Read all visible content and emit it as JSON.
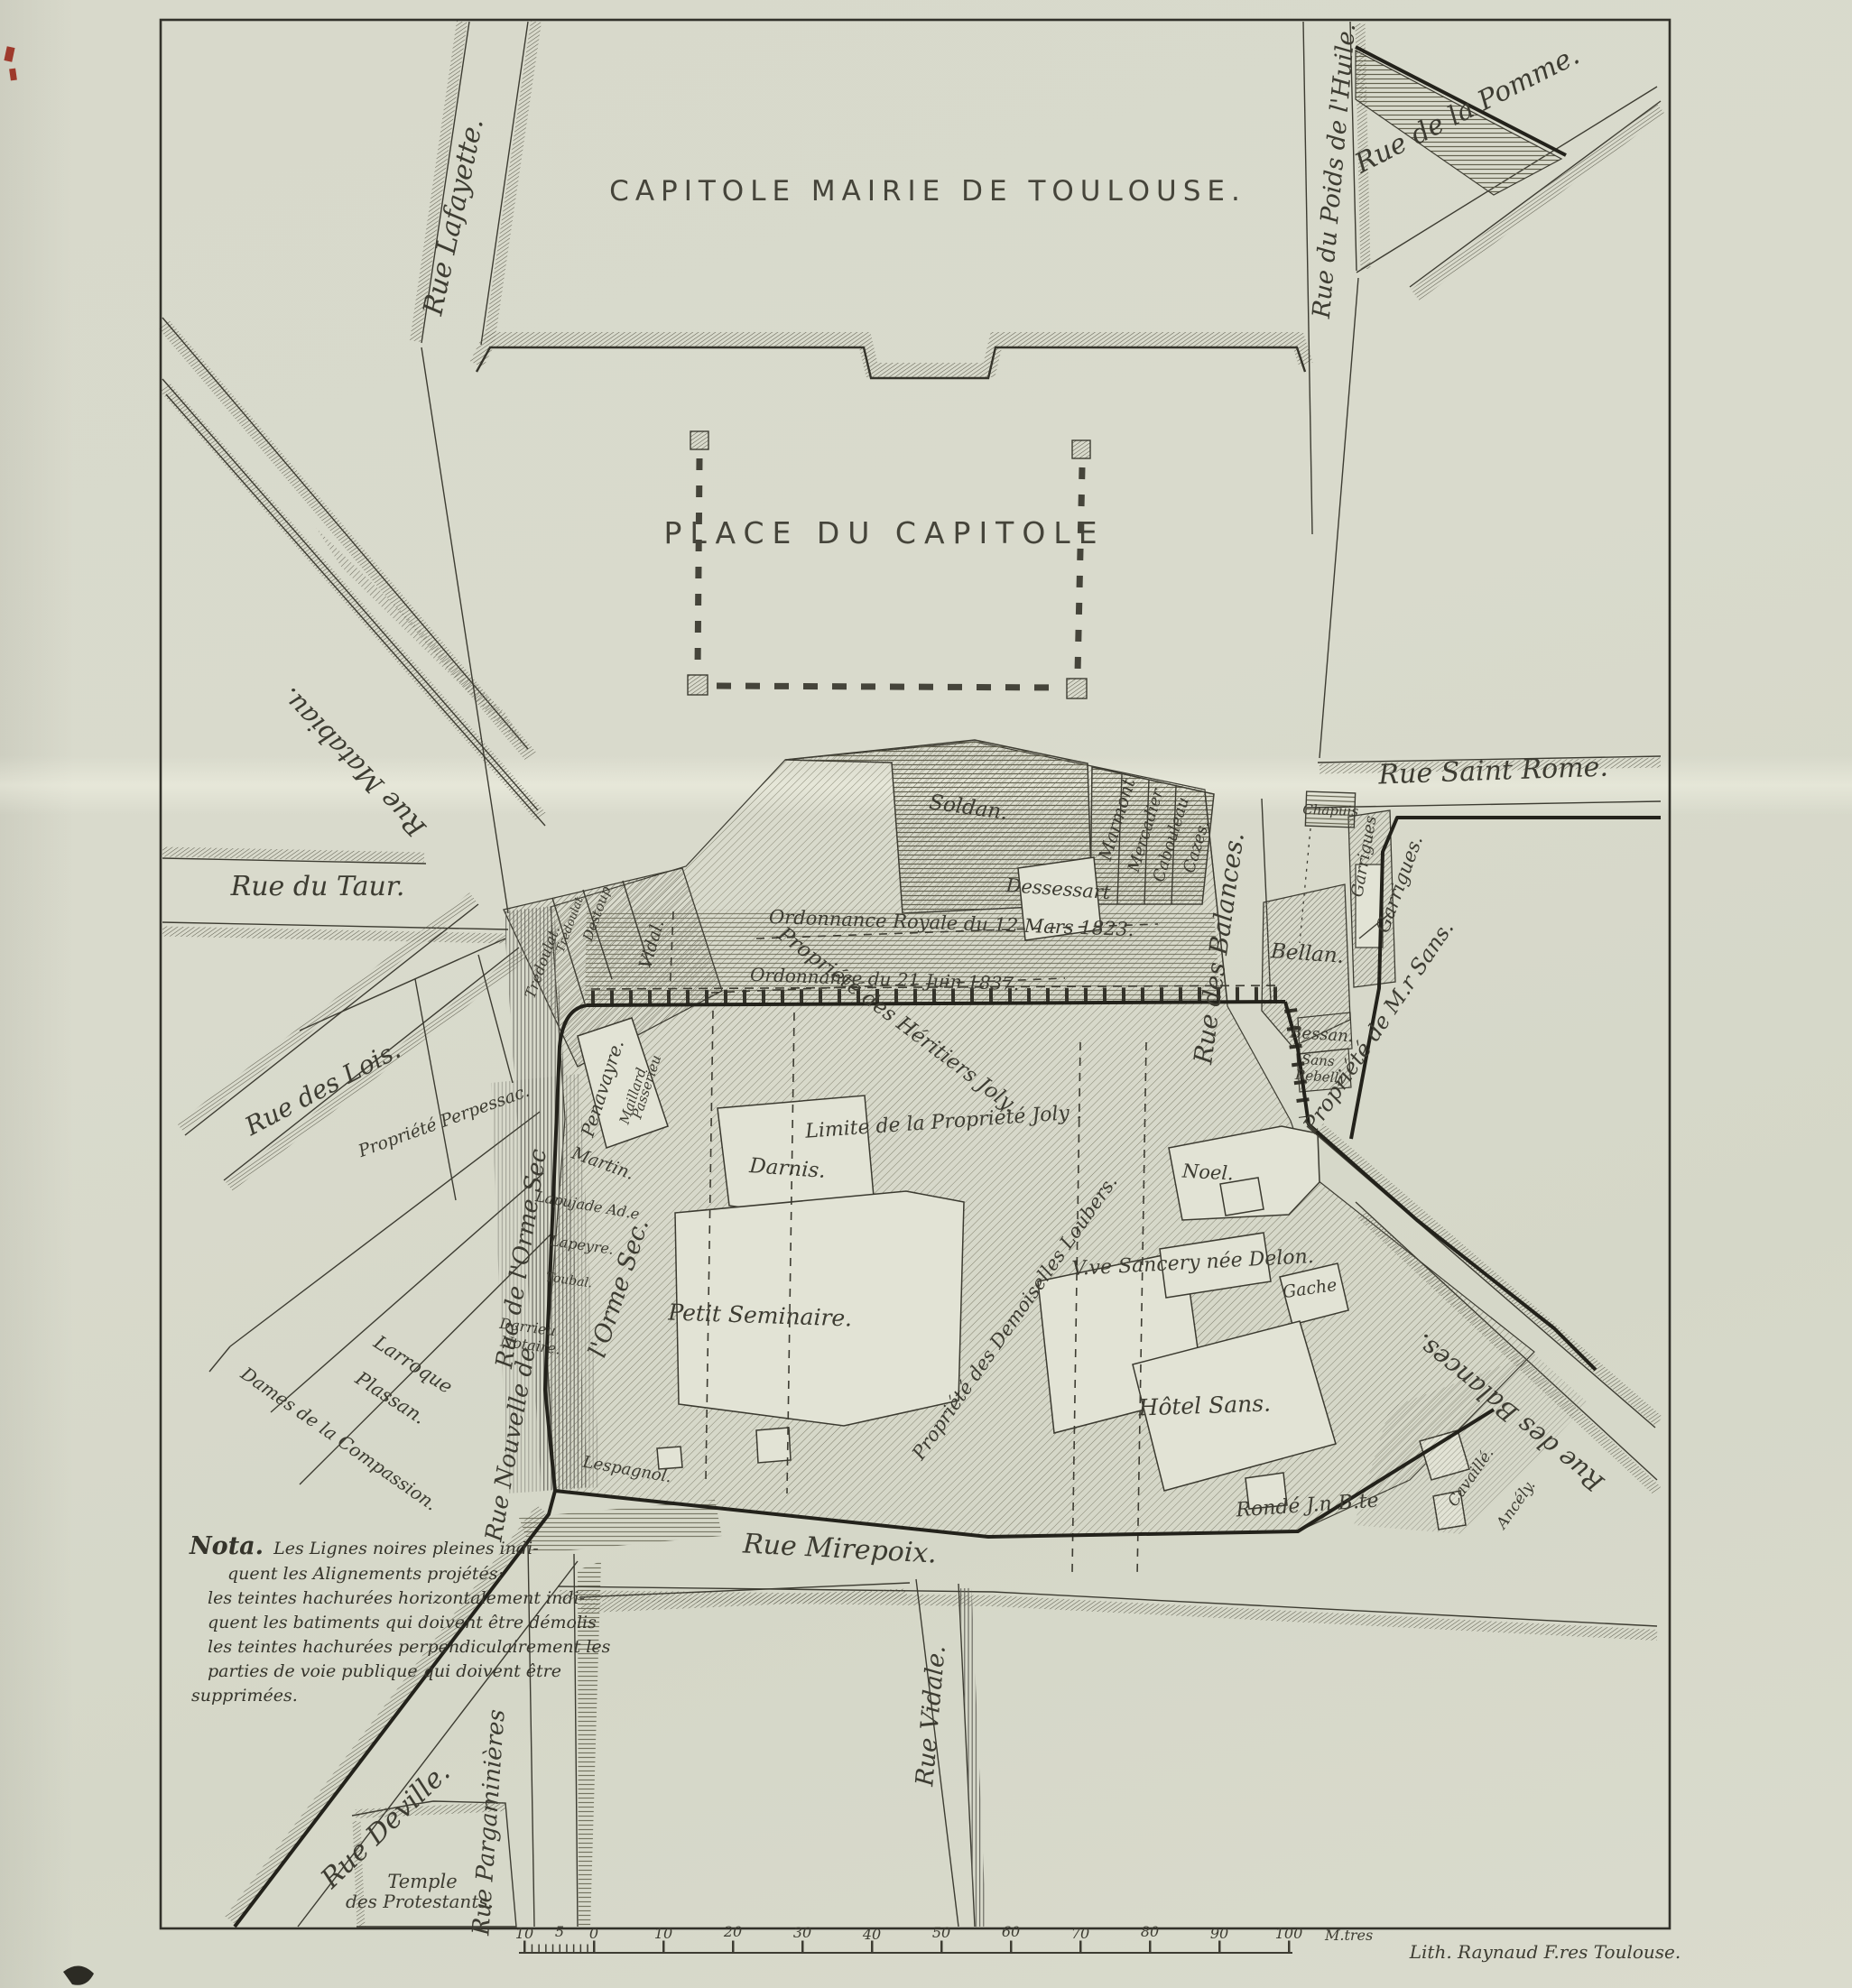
{
  "map": {
    "title": "CAPITOLE  MAIRIE  DE  TOULOUSE.",
    "place": "PLACE  DU  CAPITOLE",
    "credit": "Lith. Raynaud F.res Toulouse.",
    "scale_unit": "M.tres"
  },
  "streets": [
    {
      "name": "rue-matabiau",
      "text": "Rue  Matabiau."
    },
    {
      "name": "rue-lafayette",
      "text": "Rue  Lafayette."
    },
    {
      "name": "rue-du-poids-de-l-huile",
      "text": "Rue du Poids de l'Huile."
    },
    {
      "name": "rue-de-la-pomme",
      "text": "Rue  de  la  Pomme."
    },
    {
      "name": "rue-saint-rome",
      "text": "Rue  Saint  Rome."
    },
    {
      "name": "rue-du-taur",
      "text": "Rue   du   Taur."
    },
    {
      "name": "rue-des-lois",
      "text": "Rue  des  Lois."
    },
    {
      "name": "rue-des-balances-mid",
      "text": "Rue  des  Balances."
    },
    {
      "name": "rue-des-balances-low",
      "text": "Rue  des  Balances."
    },
    {
      "name": "rue-de-l-orme-sec-old",
      "text": "Rue  de  l'Orme  Sec"
    },
    {
      "name": "l-orme-sec-new",
      "text": "l'Orme   Sec."
    },
    {
      "name": "rue-nouvelle-de",
      "text": "Rue  Nouvelle  de"
    },
    {
      "name": "rue-mirepoix",
      "text": "Rue      Mirepoix."
    },
    {
      "name": "rue-vidale",
      "text": "Rue  Vidale."
    },
    {
      "name": "rue-deville",
      "text": "Rue   Deville."
    },
    {
      "name": "rue-pargaminieres",
      "text": "Rue Pargaminières"
    }
  ],
  "places": [
    {
      "name": "temple-line1",
      "text": "Temple"
    },
    {
      "name": "temple-line2",
      "text": "des Protestants."
    }
  ],
  "properties": [
    {
      "name": "soldan",
      "text": "Soldan."
    },
    {
      "name": "dessessart",
      "text": "Dessessart"
    },
    {
      "name": "marmont",
      "text": "Marmont"
    },
    {
      "name": "mercadier",
      "text": "Mercadier"
    },
    {
      "name": "cabouleau",
      "text": "Cabouleau"
    },
    {
      "name": "cazes",
      "text": "Cazes."
    },
    {
      "name": "chapuis",
      "text": "Chapuis"
    },
    {
      "name": "bellan",
      "text": "Bellan."
    },
    {
      "name": "garrigues-building",
      "text": "Garrigues"
    },
    {
      "name": "garrigues",
      "text": "Garrigues."
    },
    {
      "name": "bessan",
      "text": "Bessan."
    },
    {
      "name": "sans-rebelly-1",
      "text": "Sans"
    },
    {
      "name": "sans-rebelly-2",
      "text": "Rebelly"
    },
    {
      "name": "propriete-de-mr-sans",
      "text": "Propriété  de  M.r Sans."
    },
    {
      "name": "tredoulat-1",
      "text": "Tredoulat."
    },
    {
      "name": "tredoulat-2",
      "text": "Tredoulat"
    },
    {
      "name": "destoup",
      "text": "Destoup"
    },
    {
      "name": "vidal",
      "text": "Vidal."
    },
    {
      "name": "penavayre",
      "text": "Penavayre."
    },
    {
      "name": "maillard",
      "text": "Maillard"
    },
    {
      "name": "passerieu",
      "text": "Passerieu"
    },
    {
      "name": "martin",
      "text": "Martin."
    },
    {
      "name": "lapujade",
      "text": "Lapujade Ad.e"
    },
    {
      "name": "lapeyre",
      "text": "Lapeyre."
    },
    {
      "name": "toubal",
      "text": "Toubal."
    },
    {
      "name": "darrieu-1",
      "text": "Darrieu"
    },
    {
      "name": "darrieu-2",
      "text": "Notaire."
    },
    {
      "name": "perpessac",
      "text": "Propriété Perpessac."
    },
    {
      "name": "larroque",
      "text": "Larroque"
    },
    {
      "name": "plassan",
      "text": "Plassan."
    },
    {
      "name": "compassion",
      "text": "Dames de la Compassion."
    },
    {
      "name": "lespagnol",
      "text": "Lespagnol."
    },
    {
      "name": "darnis",
      "text": "Darnis."
    },
    {
      "name": "petit-seminaire",
      "text": "Petit Seminaire."
    },
    {
      "name": "loubers",
      "text": "Propriété des Demoiselles Loubers."
    },
    {
      "name": "noel",
      "text": "Noel."
    },
    {
      "name": "sancery",
      "text": "V.ve Sancery née Delon."
    },
    {
      "name": "gache",
      "text": "Gache"
    },
    {
      "name": "hotel-sans",
      "text": "Hôtel  Sans."
    },
    {
      "name": "ronde",
      "text": "Rondé  J.n  B.te"
    },
    {
      "name": "cavaille",
      "text": "Cavaillé."
    },
    {
      "name": "ancely",
      "text": "Ancély."
    },
    {
      "name": "heritiers-joly",
      "text": "Propriété  des  Héritiers  Joly."
    },
    {
      "name": "limite-joly",
      "text": "Limite  de  la  Propriété  Joly ."
    },
    {
      "name": "ordonnance-1823",
      "text": "Ordonnance    Royale    du    12    Mars    1823."
    },
    {
      "name": "ordonnance-1837",
      "text": "Ordonnance      du      21      Juin      1837."
    }
  ],
  "nota": {
    "heading": "Nota.",
    "line1": "Les Lignes noires pleines indi-",
    "lines": [
      "quent les Alignements projétés:",
      "les teintes hachurées horizontalement indi-",
      "quent les batiments qui doivent être démolis",
      "les teintes hachurées perpendiculairement les",
      "parties de voie publique qui doivent être",
      "supprimées."
    ]
  },
  "scale_bar": {
    "numbers": [
      "10",
      "5",
      "0",
      "10",
      "20",
      "30",
      "40",
      "50",
      "60",
      "70",
      "80",
      "90",
      "100"
    ]
  }
}
